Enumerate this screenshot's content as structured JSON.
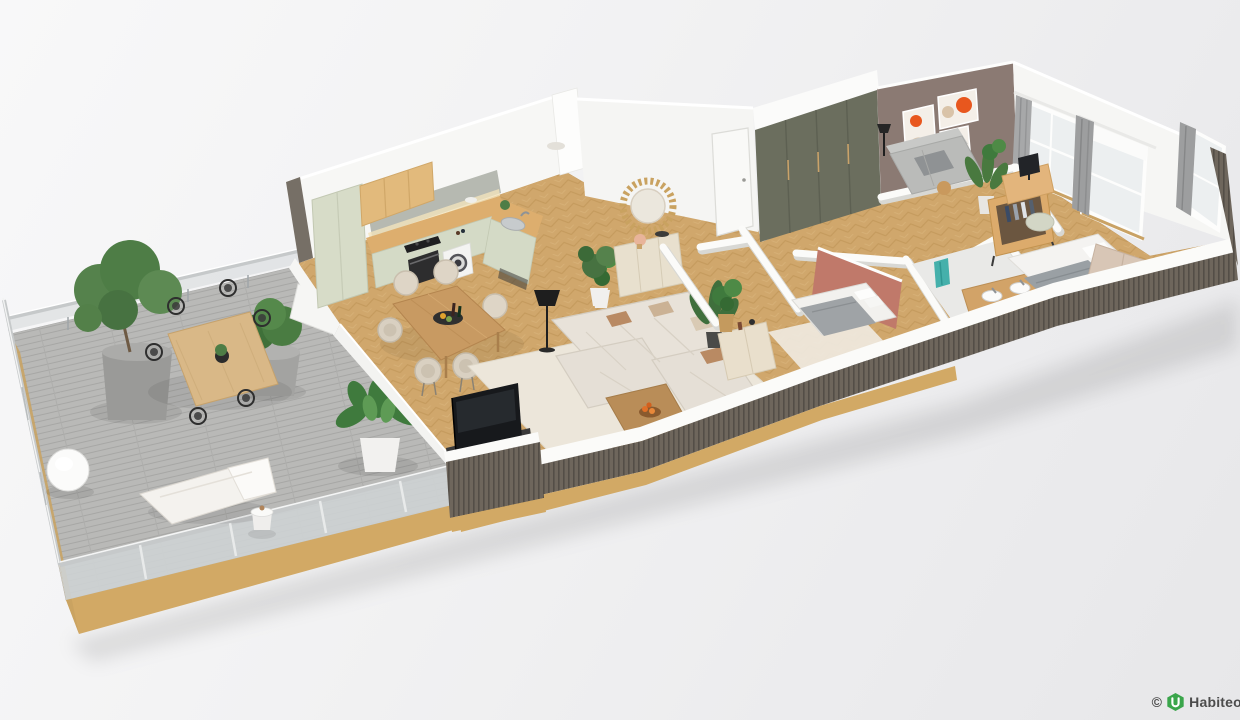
{
  "scene": {
    "title": "3D apartment floor plan render",
    "style": "isometric cutaway 3D floor plan, long apartment with terrace",
    "rooms": [
      {
        "name": "terrace",
        "features": [
          "gray wood deck",
          "frosted glass railing",
          "olive tree in round gray planter",
          "boxwood bush in pot",
          "wood outdoor dining table",
          "six black wire chairs",
          "white sphere floor lamp",
          "white sun lounger",
          "round side table",
          "large green plant in white pot",
          "white bench"
        ]
      },
      {
        "name": "kitchen",
        "features": [
          "sage green cabinets",
          "tall fridge unit",
          "wood upper cabinets",
          "gray backsplash",
          "wood countertop",
          "black hob",
          "built-in oven",
          "washing machine",
          "corner sink with faucet",
          "plant and bowls decor"
        ]
      },
      {
        "name": "dining-area",
        "features": [
          "oak dining table",
          "six beige rounded chairs",
          "black serving tray",
          "wine bottles"
        ]
      },
      {
        "name": "living-room",
        "features": [
          "beige modular sectional sofa",
          "cream rug",
          "wood coffee table",
          "fruit bowl",
          "flat TV on black media unit",
          "black floor lamp",
          "kentia palm",
          "green plant",
          "wood console"
        ]
      },
      {
        "name": "entry-hall",
        "features": [
          "round sunburst mirror",
          "cream sideboard with lamp",
          "potted plant",
          "olive-green full-height wardrobe",
          "white door"
        ]
      },
      {
        "name": "bedroom-2",
        "features": [
          "terracotta accent wall",
          "double bed with gray throw",
          "white pillows",
          "black round side table",
          "plant in basket",
          "cream rug"
        ]
      },
      {
        "name": "bathroom",
        "features": [
          "wood double vanity",
          "two white basins with chrome faucets",
          "teal towels",
          "green bath mat"
        ]
      },
      {
        "name": "master-bedroom",
        "features": [
          "double bed white duvet and gray blanket",
          "beige headboard",
          "sage pouf",
          "open wood wardrobe with clothes",
          "desk with monitor",
          "two windows with gray curtains",
          "corner window"
        ]
      },
      {
        "name": "office-lounge",
        "features": [
          "mauve accent wall",
          "three abstract orange artworks",
          "light gray sofa",
          "black floor lamp",
          "tall plant",
          "wood side table"
        ]
      }
    ],
    "palette": {
      "background": "#f0f0f2",
      "floor_oak": "#d0a76c",
      "terrace_deck": "#b9b9b7",
      "wall_white": "#f9f9f8",
      "cladding_dark": "#6b6359",
      "slab_tan": "#d2a965",
      "kitchen_mint": "#d6dcc8",
      "counter_wood": "#ddae6e",
      "wardrobe_olive": "#6b6e5e",
      "accent_terracotta": "#c0796a",
      "accent_mauve": "#8b7a73",
      "art_orange": "#e8571e",
      "sofa_beige": "#e8e2d9",
      "rug_cream": "#ece6da",
      "curtain_gray": "#a7a8a9",
      "towel_teal": "#45b0ab",
      "plant_green": "#4e7d46"
    }
  },
  "watermark": {
    "copyright": "©",
    "brand": "Habiteo.",
    "logo_color": "#3aa54b",
    "text_color": "#4c4c4c"
  }
}
